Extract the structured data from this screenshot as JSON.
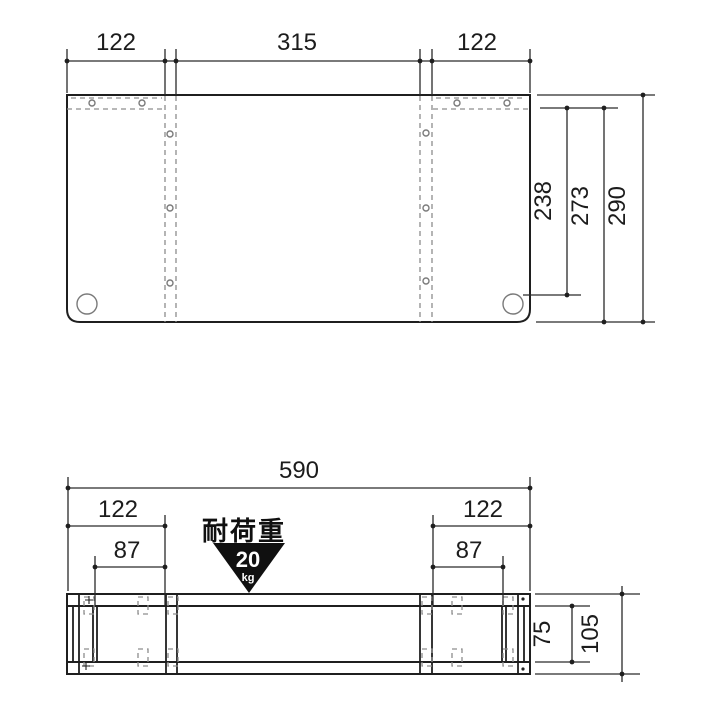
{
  "figure": {
    "background": "#ffffff",
    "object_line_color": "#1f1f1f",
    "dimension_line_color": "#2a2a2a",
    "hidden_line_color": "#8d8d8d",
    "badge_color": "#101010",
    "badge_text_color": "#ffffff"
  },
  "top_view": {
    "width_dims": {
      "left": "122",
      "center": "315",
      "right": "122"
    },
    "depth_dims": {
      "to_hole": "238",
      "inner": "273",
      "total": "290"
    }
  },
  "bottom_view": {
    "total_width": "590",
    "left_section": {
      "width": "122",
      "offset": "87"
    },
    "right_section": {
      "width": "122",
      "offset": "87"
    },
    "inner_height": "75",
    "total_height": "105",
    "load_badge": {
      "title": "耐荷重",
      "value": "20",
      "unit": "kg"
    }
  }
}
